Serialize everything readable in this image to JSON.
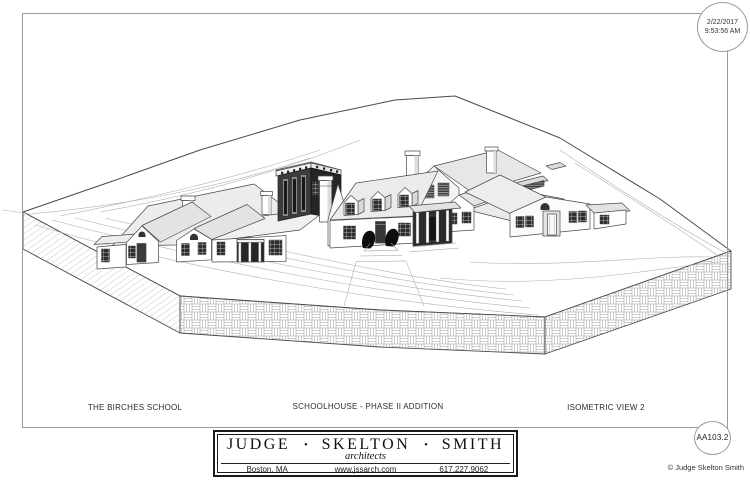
{
  "stamp": {
    "date": "2/22/2017",
    "time": "9:53:56 AM"
  },
  "titles": {
    "project": "THE BIRCHES SCHOOL",
    "drawing": "SCHOOLHOUSE - PHASE II ADDITION",
    "view": "ISOMETRIC VIEW 2"
  },
  "title_block": {
    "firm": [
      "JUDGE",
      "SKELTON",
      "SMITH"
    ],
    "separator": "•",
    "tagline": "architects",
    "address": "Boston, MA",
    "website": "www.jssarch.com",
    "phone": "617.227.9062"
  },
  "sheet_number": "AA103.2",
  "copyright": {
    "symbol": "©",
    "text": "Judge Skelton Smith"
  },
  "palette": {
    "paper": "#ffffff",
    "border": "#9a9a9a",
    "line": "#4a4a4a",
    "roof_light": "#ebebeb",
    "addition_front": "#3c3c3c",
    "addition_side": "#262626"
  }
}
